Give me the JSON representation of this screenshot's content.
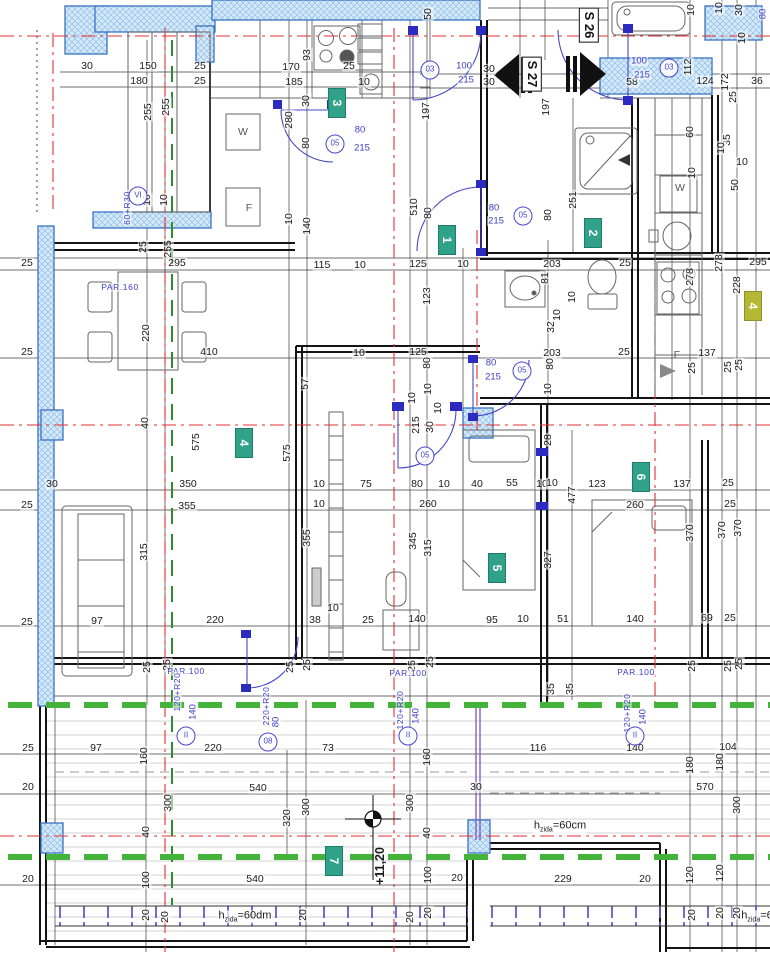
{
  "drawing_title": "floor-plan-level +11,20",
  "colors": {
    "wall_hatch": "#d6e9f8",
    "wall_border": "#3a72c0",
    "door_blue": "#4747c8",
    "green_section": "#44b33c",
    "axis_red": "#e03030",
    "badge_teal": "#2fa289",
    "badge_yellow": "#b5b832"
  },
  "section_labels": [
    {
      "t": "S 26",
      "x": 589,
      "y": 25
    },
    {
      "t": "S 27",
      "x": 532,
      "y": 74
    }
  ],
  "room_badges": [
    {
      "t": "3",
      "x": 337,
      "y": 103
    },
    {
      "t": "1",
      "x": 447,
      "y": 240
    },
    {
      "t": "2",
      "x": 593,
      "y": 233
    },
    {
      "t": "4",
      "x": 244,
      "y": 443
    },
    {
      "t": "4",
      "x": 753,
      "y": 306,
      "yellow": true
    },
    {
      "t": "5",
      "x": 497,
      "y": 568
    },
    {
      "t": "6",
      "x": 641,
      "y": 477
    },
    {
      "t": "7",
      "x": 334,
      "y": 861
    }
  ],
  "level_labels": [
    {
      "t": "+11,20",
      "x": 380,
      "y": 866,
      "v": 0
    }
  ],
  "wall_height_labels": [
    {
      "pre": "h",
      "sub": "zida",
      "post": "=60cm",
      "x": 560,
      "y": 827
    },
    {
      "pre": "h",
      "sub": "zida",
      "post": "=60dm",
      "x": 245,
      "y": 917
    },
    {
      "pre": "h",
      "sub": "zida",
      "post": "=6",
      "x": 757,
      "y": 917
    }
  ],
  "circle_labels": [
    {
      "t": "03",
      "x": 430,
      "y": 70
    },
    {
      "t": "03",
      "x": 669,
      "y": 68
    },
    {
      "t": "05",
      "x": 335,
      "y": 144
    },
    {
      "t": "05",
      "x": 523,
      "y": 216
    },
    {
      "t": "05",
      "x": 522,
      "y": 371
    },
    {
      "t": "05",
      "x": 425,
      "y": 456
    },
    {
      "t": "08",
      "x": 268,
      "y": 742
    },
    {
      "t": "II",
      "x": 186,
      "y": 736
    },
    {
      "t": "II",
      "x": 408,
      "y": 736
    },
    {
      "t": "II",
      "x": 635,
      "y": 736
    },
    {
      "t": "VI",
      "x": 138,
      "y": 196
    }
  ],
  "blue_labels": [
    {
      "t": "80",
      "x": 360,
      "y": 130
    },
    {
      "t": "215",
      "x": 362,
      "y": 148
    },
    {
      "t": "100",
      "x": 464,
      "y": 66
    },
    {
      "t": "215",
      "x": 466,
      "y": 80
    },
    {
      "t": "100",
      "x": 639,
      "y": 61
    },
    {
      "t": "215",
      "x": 642,
      "y": 75
    },
    {
      "t": "80",
      "x": 494,
      "y": 208
    },
    {
      "t": "215",
      "x": 496,
      "y": 221
    },
    {
      "t": "80",
      "x": 491,
      "y": 363
    },
    {
      "t": "215",
      "x": 493,
      "y": 377
    },
    {
      "t": "80",
      "x": 763,
      "y": 14,
      "v": 1
    },
    {
      "t": "PAR.100",
      "x": 186,
      "y": 671,
      "par": 1
    },
    {
      "t": "PAR.100",
      "x": 408,
      "y": 673,
      "par": 1
    },
    {
      "t": "PAR.100",
      "x": 636,
      "y": 672,
      "par": 1
    },
    {
      "t": "PAR.160",
      "x": 120,
      "y": 287,
      "par": 1
    },
    {
      "t": "120+R20",
      "x": 177,
      "y": 692,
      "v": 1,
      "par": 1
    },
    {
      "t": "140",
      "x": 193,
      "y": 712,
      "v": 1
    },
    {
      "t": "220+R20",
      "x": 266,
      "y": 706,
      "v": 1,
      "par": 1
    },
    {
      "t": "80",
      "x": 276,
      "y": 722,
      "v": 1
    },
    {
      "t": "120+R20",
      "x": 400,
      "y": 710,
      "v": 1,
      "par": 1
    },
    {
      "t": "140",
      "x": 416,
      "y": 716,
      "v": 1
    },
    {
      "t": "120+R20",
      "x": 627,
      "y": 713,
      "v": 1,
      "par": 1
    },
    {
      "t": "140",
      "x": 643,
      "y": 717,
      "v": 1
    },
    {
      "t": "60+R30",
      "x": 127,
      "y": 208,
      "v": 1,
      "par": 1
    }
  ],
  "fixture_labels": [
    {
      "t": "W",
      "x": 243,
      "y": 132
    },
    {
      "t": "F",
      "x": 249,
      "y": 208
    },
    {
      "t": "W",
      "x": 680,
      "y": 188
    },
    {
      "t": "F",
      "x": 677,
      "y": 355
    }
  ],
  "dim_labels": [
    {
      "t": "30",
      "x": 87,
      "y": 66
    },
    {
      "t": "150",
      "x": 148,
      "y": 66
    },
    {
      "t": "25",
      "x": 200,
      "y": 66
    },
    {
      "t": "180",
      "x": 139,
      "y": 81
    },
    {
      "t": "25",
      "x": 200,
      "y": 81
    },
    {
      "t": "255",
      "x": 148,
      "y": 112,
      "v": 1
    },
    {
      "t": "255",
      "x": 166,
      "y": 107,
      "v": 1
    },
    {
      "t": "10",
      "x": 147,
      "y": 200,
      "v": 1
    },
    {
      "t": "10",
      "x": 164,
      "y": 200,
      "v": 1
    },
    {
      "t": "25",
      "x": 143,
      "y": 247,
      "v": 1
    },
    {
      "t": "255",
      "x": 168,
      "y": 249,
      "v": 1
    },
    {
      "t": "295",
      "x": 177,
      "y": 263
    },
    {
      "t": "93",
      "x": 307,
      "y": 55,
      "v": 1
    },
    {
      "t": "170",
      "x": 291,
      "y": 67
    },
    {
      "t": "25",
      "x": 349,
      "y": 66
    },
    {
      "t": "185",
      "x": 294,
      "y": 82
    },
    {
      "t": "10",
      "x": 364,
      "y": 82
    },
    {
      "t": "30",
      "x": 306,
      "y": 101,
      "v": 1
    },
    {
      "t": "280",
      "x": 289,
      "y": 120,
      "v": 1
    },
    {
      "t": "80",
      "x": 306,
      "y": 143,
      "v": 1
    },
    {
      "t": "140",
      "x": 307,
      "y": 226,
      "v": 1
    },
    {
      "t": "10",
      "x": 289,
      "y": 219,
      "v": 1
    },
    {
      "t": "50",
      "x": 428,
      "y": 14,
      "v": 1
    },
    {
      "t": "197",
      "x": 426,
      "y": 111,
      "v": 1
    },
    {
      "t": "510",
      "x": 414,
      "y": 207,
      "v": 1
    },
    {
      "t": "80",
      "x": 428,
      "y": 213,
      "v": 1
    },
    {
      "t": "30",
      "x": 489,
      "y": 69
    },
    {
      "t": "30",
      "x": 489,
      "y": 82
    },
    {
      "t": "58",
      "x": 632,
      "y": 82
    },
    {
      "t": "124",
      "x": 705,
      "y": 81
    },
    {
      "t": "172",
      "x": 725,
      "y": 82,
      "v": 1
    },
    {
      "t": "36",
      "x": 757,
      "y": 81
    },
    {
      "t": "112",
      "x": 688,
      "y": 67,
      "v": 1
    },
    {
      "t": "25",
      "x": 733,
      "y": 97,
      "v": 1
    },
    {
      "t": "10",
      "x": 691,
      "y": 10,
      "v": 1
    },
    {
      "t": "10",
      "x": 719,
      "y": 8,
      "v": 1
    },
    {
      "t": "30",
      "x": 739,
      "y": 10,
      "v": 1
    },
    {
      "t": "10",
      "x": 742,
      "y": 38,
      "v": 1
    },
    {
      "t": "197",
      "x": 546,
      "y": 107,
      "v": 1
    },
    {
      "t": "251",
      "x": 573,
      "y": 200,
      "v": 1
    },
    {
      "t": "80",
      "x": 548,
      "y": 215,
      "v": 1
    },
    {
      "t": "60",
      "x": 690,
      "y": 132,
      "v": 1
    },
    {
      "t": "35",
      "x": 727,
      "y": 140,
      "v": 1
    },
    {
      "t": "10",
      "x": 721,
      "y": 148,
      "v": 1
    },
    {
      "t": "10",
      "x": 742,
      "y": 162
    },
    {
      "t": "50",
      "x": 735,
      "y": 185,
      "v": 1
    },
    {
      "t": "10",
      "x": 692,
      "y": 173,
      "v": 1
    },
    {
      "t": "115",
      "x": 322,
      "y": 265
    },
    {
      "t": "10",
      "x": 360,
      "y": 265
    },
    {
      "t": "125",
      "x": 418,
      "y": 264
    },
    {
      "t": "10",
      "x": 463,
      "y": 264
    },
    {
      "t": "123",
      "x": 427,
      "y": 296,
      "v": 1
    },
    {
      "t": "203",
      "x": 552,
      "y": 264
    },
    {
      "t": "25",
      "x": 625,
      "y": 263
    },
    {
      "t": "81",
      "x": 545,
      "y": 278,
      "v": 1
    },
    {
      "t": "295",
      "x": 758,
      "y": 262
    },
    {
      "t": "278",
      "x": 719,
      "y": 263,
      "v": 1
    },
    {
      "t": "278",
      "x": 690,
      "y": 277,
      "v": 1
    },
    {
      "t": "228",
      "x": 737,
      "y": 285,
      "v": 1
    },
    {
      "t": "10",
      "x": 572,
      "y": 297,
      "v": 1
    },
    {
      "t": "10",
      "x": 557,
      "y": 315,
      "v": 1
    },
    {
      "t": "32",
      "x": 551,
      "y": 327,
      "v": 1
    },
    {
      "t": "125",
      "x": 418,
      "y": 352
    },
    {
      "t": "10",
      "x": 359,
      "y": 353
    },
    {
      "t": "80",
      "x": 427,
      "y": 363,
      "v": 1
    },
    {
      "t": "203",
      "x": 552,
      "y": 353
    },
    {
      "t": "25",
      "x": 624,
      "y": 352
    },
    {
      "t": "137",
      "x": 707,
      "y": 353
    },
    {
      "t": "80",
      "x": 550,
      "y": 364,
      "v": 1
    },
    {
      "t": "10",
      "x": 548,
      "y": 389,
      "v": 1
    },
    {
      "t": "10",
      "x": 428,
      "y": 389,
      "v": 1
    },
    {
      "t": "10",
      "x": 412,
      "y": 398,
      "v": 1
    },
    {
      "t": "10",
      "x": 438,
      "y": 408,
      "v": 1
    },
    {
      "t": "30",
      "x": 430,
      "y": 427,
      "v": 1
    },
    {
      "t": "215",
      "x": 416,
      "y": 425,
      "v": 1
    },
    {
      "t": "28",
      "x": 548,
      "y": 440,
      "v": 1
    },
    {
      "t": "25",
      "x": 692,
      "y": 368,
      "v": 1
    },
    {
      "t": "25",
      "x": 728,
      "y": 367,
      "v": 1
    },
    {
      "t": "25",
      "x": 739,
      "y": 365,
      "v": 1
    },
    {
      "t": "25",
      "x": 27,
      "y": 263
    },
    {
      "t": "25",
      "x": 27,
      "y": 352
    },
    {
      "t": "220",
      "x": 146,
      "y": 333,
      "v": 1
    },
    {
      "t": "410",
      "x": 209,
      "y": 352
    },
    {
      "t": "40",
      "x": 145,
      "y": 423,
      "v": 1
    },
    {
      "t": "57",
      "x": 305,
      "y": 384,
      "v": 1
    },
    {
      "t": "575",
      "x": 287,
      "y": 453,
      "v": 1
    },
    {
      "t": "575",
      "x": 196,
      "y": 442,
      "v": 1
    },
    {
      "t": "350",
      "x": 188,
      "y": 484
    },
    {
      "t": "355",
      "x": 187,
      "y": 506
    },
    {
      "t": "30",
      "x": 52,
      "y": 484
    },
    {
      "t": "10",
      "x": 319,
      "y": 484
    },
    {
      "t": "75",
      "x": 366,
      "y": 484
    },
    {
      "t": "80",
      "x": 417,
      "y": 484
    },
    {
      "t": "10",
      "x": 444,
      "y": 484
    },
    {
      "t": "40",
      "x": 477,
      "y": 484
    },
    {
      "t": "55",
      "x": 512,
      "y": 483
    },
    {
      "t": "10",
      "x": 542,
      "y": 484
    },
    {
      "t": "260",
      "x": 428,
      "y": 504
    },
    {
      "t": "10",
      "x": 319,
      "y": 504
    },
    {
      "t": "10",
      "x": 552,
      "y": 483
    },
    {
      "t": "123",
      "x": 597,
      "y": 484
    },
    {
      "t": "137",
      "x": 682,
      "y": 484
    },
    {
      "t": "25",
      "x": 728,
      "y": 483
    },
    {
      "t": "477",
      "x": 572,
      "y": 495,
      "v": 1
    },
    {
      "t": "260",
      "x": 635,
      "y": 505
    },
    {
      "t": "25",
      "x": 730,
      "y": 504
    },
    {
      "t": "355",
      "x": 307,
      "y": 538,
      "v": 1
    },
    {
      "t": "345",
      "x": 413,
      "y": 541,
      "v": 1
    },
    {
      "t": "315",
      "x": 428,
      "y": 548,
      "v": 1
    },
    {
      "t": "370",
      "x": 690,
      "y": 533,
      "v": 1
    },
    {
      "t": "370",
      "x": 722,
      "y": 530,
      "v": 1
    },
    {
      "t": "370",
      "x": 738,
      "y": 528,
      "v": 1
    },
    {
      "t": "327",
      "x": 548,
      "y": 560,
      "v": 1
    },
    {
      "t": "25",
      "x": 27,
      "y": 505
    },
    {
      "t": "315",
      "x": 144,
      "y": 552,
      "v": 1
    },
    {
      "t": "97",
      "x": 97,
      "y": 621
    },
    {
      "t": "25",
      "x": 27,
      "y": 622
    },
    {
      "t": "220",
      "x": 215,
      "y": 620
    },
    {
      "t": "38",
      "x": 315,
      "y": 620
    },
    {
      "t": "10",
      "x": 333,
      "y": 608
    },
    {
      "t": "25",
      "x": 368,
      "y": 620
    },
    {
      "t": "140",
      "x": 417,
      "y": 619
    },
    {
      "t": "95",
      "x": 492,
      "y": 620
    },
    {
      "t": "10",
      "x": 523,
      "y": 619
    },
    {
      "t": "51",
      "x": 563,
      "y": 619
    },
    {
      "t": "140",
      "x": 635,
      "y": 619
    },
    {
      "t": "69",
      "x": 707,
      "y": 618
    },
    {
      "t": "25",
      "x": 730,
      "y": 618
    },
    {
      "t": "25",
      "x": 147,
      "y": 667,
      "v": 1
    },
    {
      "t": "25",
      "x": 167,
      "y": 665,
      "v": 1
    },
    {
      "t": "25",
      "x": 290,
      "y": 667,
      "v": 1
    },
    {
      "t": "25",
      "x": 307,
      "y": 665,
      "v": 1
    },
    {
      "t": "25",
      "x": 412,
      "y": 666,
      "v": 1
    },
    {
      "t": "25",
      "x": 430,
      "y": 662,
      "v": 1
    },
    {
      "t": "35",
      "x": 551,
      "y": 689,
      "v": 1
    },
    {
      "t": "35",
      "x": 570,
      "y": 689,
      "v": 1
    },
    {
      "t": "25",
      "x": 692,
      "y": 666,
      "v": 1
    },
    {
      "t": "25",
      "x": 728,
      "y": 666,
      "v": 1
    },
    {
      "t": "25",
      "x": 739,
      "y": 664,
      "v": 1
    },
    {
      "t": "25",
      "x": 28,
      "y": 748
    },
    {
      "t": "97",
      "x": 96,
      "y": 748
    },
    {
      "t": "160",
      "x": 144,
      "y": 756,
      "v": 1
    },
    {
      "t": "220",
      "x": 213,
      "y": 748
    },
    {
      "t": "73",
      "x": 328,
      "y": 748
    },
    {
      "t": "160",
      "x": 427,
      "y": 757,
      "v": 1
    },
    {
      "t": "116",
      "x": 538,
      "y": 748
    },
    {
      "t": "140",
      "x": 635,
      "y": 748
    },
    {
      "t": "104",
      "x": 728,
      "y": 747
    },
    {
      "t": "180",
      "x": 690,
      "y": 765,
      "v": 1
    },
    {
      "t": "180",
      "x": 720,
      "y": 762,
      "v": 1
    },
    {
      "t": "20",
      "x": 28,
      "y": 787
    },
    {
      "t": "540",
      "x": 258,
      "y": 788
    },
    {
      "t": "30",
      "x": 476,
      "y": 787
    },
    {
      "t": "570",
      "x": 705,
      "y": 787
    },
    {
      "t": "300",
      "x": 168,
      "y": 803,
      "v": 1
    },
    {
      "t": "300",
      "x": 306,
      "y": 807,
      "v": 1
    },
    {
      "t": "300",
      "x": 410,
      "y": 803,
      "v": 1
    },
    {
      "t": "300",
      "x": 737,
      "y": 805,
      "v": 1
    },
    {
      "t": "320",
      "x": 287,
      "y": 818,
      "v": 1
    },
    {
      "t": "40",
      "x": 146,
      "y": 832,
      "v": 1
    },
    {
      "t": "40",
      "x": 427,
      "y": 833,
      "v": 1
    },
    {
      "t": "100",
      "x": 146,
      "y": 880,
      "v": 1
    },
    {
      "t": "100",
      "x": 428,
      "y": 875,
      "v": 1
    },
    {
      "t": "20",
      "x": 28,
      "y": 879
    },
    {
      "t": "540",
      "x": 255,
      "y": 879
    },
    {
      "t": "20",
      "x": 457,
      "y": 878
    },
    {
      "t": "229",
      "x": 563,
      "y": 879
    },
    {
      "t": "20",
      "x": 645,
      "y": 879
    },
    {
      "t": "120",
      "x": 690,
      "y": 875,
      "v": 1
    },
    {
      "t": "120",
      "x": 720,
      "y": 873,
      "v": 1
    },
    {
      "t": "20",
      "x": 146,
      "y": 915,
      "v": 1
    },
    {
      "t": "20",
      "x": 165,
      "y": 917,
      "v": 1
    },
    {
      "t": "20",
      "x": 303,
      "y": 915,
      "v": 1
    },
    {
      "t": "20",
      "x": 410,
      "y": 917,
      "v": 1
    },
    {
      "t": "20",
      "x": 428,
      "y": 913,
      "v": 1
    },
    {
      "t": "20",
      "x": 692,
      "y": 915,
      "v": 1
    },
    {
      "t": "20",
      "x": 720,
      "y": 913,
      "v": 1
    },
    {
      "t": "20",
      "x": 737,
      "y": 913,
      "v": 1
    }
  ]
}
